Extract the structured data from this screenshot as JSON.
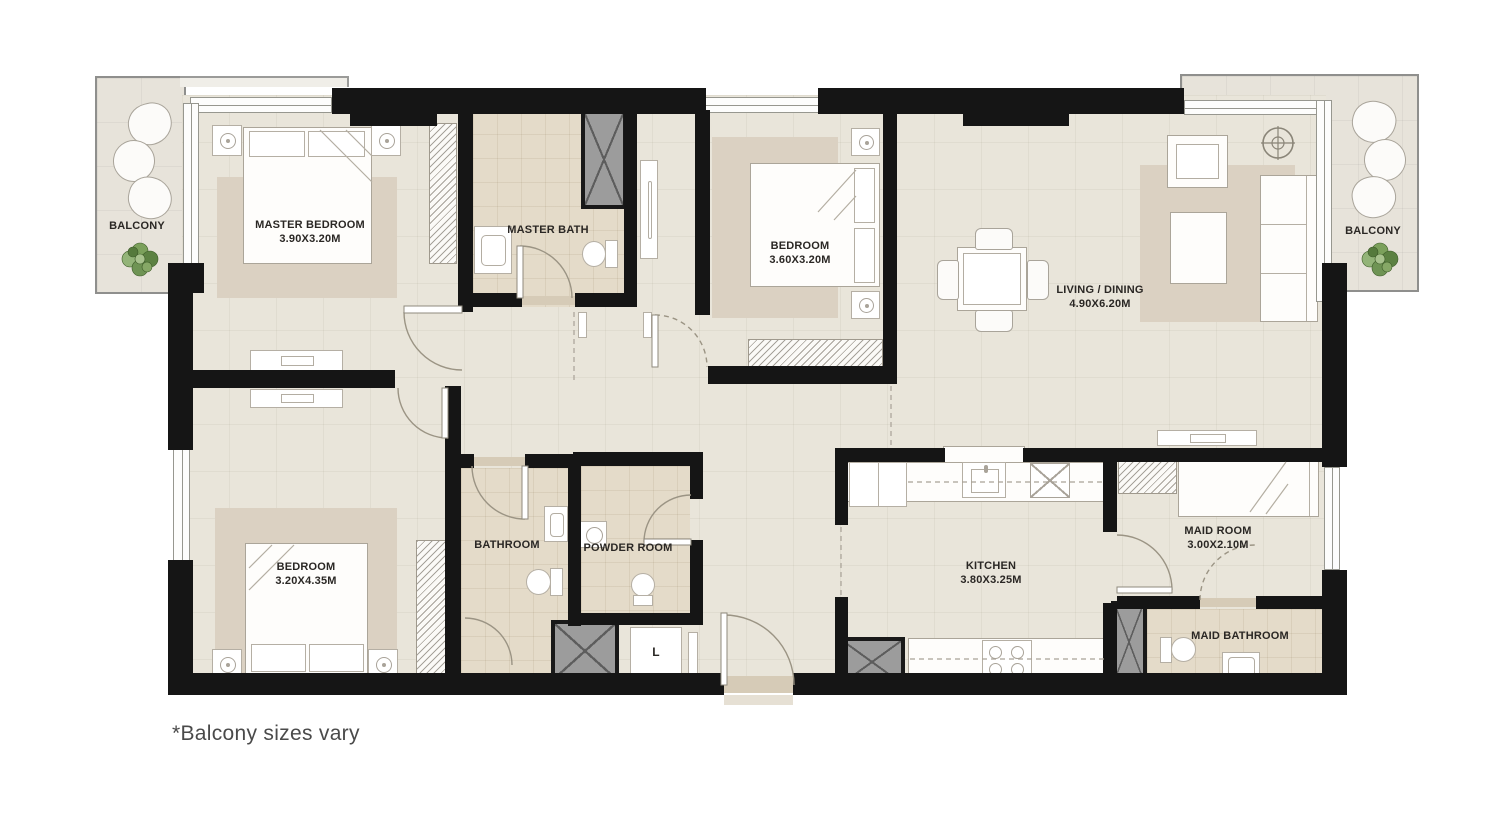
{
  "page": {
    "footnote": "*Balcony sizes vary"
  },
  "rooms": {
    "balcony_left": {
      "name": "BALCONY"
    },
    "master_bedroom": {
      "name": "MASTER BEDROOM",
      "dims": "3.90X3.20M"
    },
    "master_bath": {
      "name": "MASTER BATH"
    },
    "bedroom_top": {
      "name": "BEDROOM",
      "dims": "3.60X3.20M"
    },
    "living_dining": {
      "name": "LIVING / DINING",
      "dims": "4.90X6.20M"
    },
    "balcony_right": {
      "name": "BALCONY"
    },
    "bedroom_bottom": {
      "name": "BEDROOM",
      "dims": "3.20X4.35M"
    },
    "bathroom": {
      "name": "BATHROOM"
    },
    "powder_room": {
      "name": "POWDER ROOM"
    },
    "kitchen": {
      "name": "KITCHEN",
      "dims": "3.80X3.25M"
    },
    "maid_room": {
      "name": "MAID ROOM",
      "dims": "3.00X2.10M"
    },
    "maid_bathroom": {
      "name": "MAID BATHROOM"
    },
    "laundry_closet": {
      "name": "L"
    }
  },
  "colors": {
    "wall": "#151515",
    "floor": "#e9e5da",
    "bath_floor": "#e4dbc9",
    "rug": "#dbd1c2",
    "balcony": "#e7e3da",
    "plant": "#6f9454",
    "shaft": "#9c9c9c"
  }
}
